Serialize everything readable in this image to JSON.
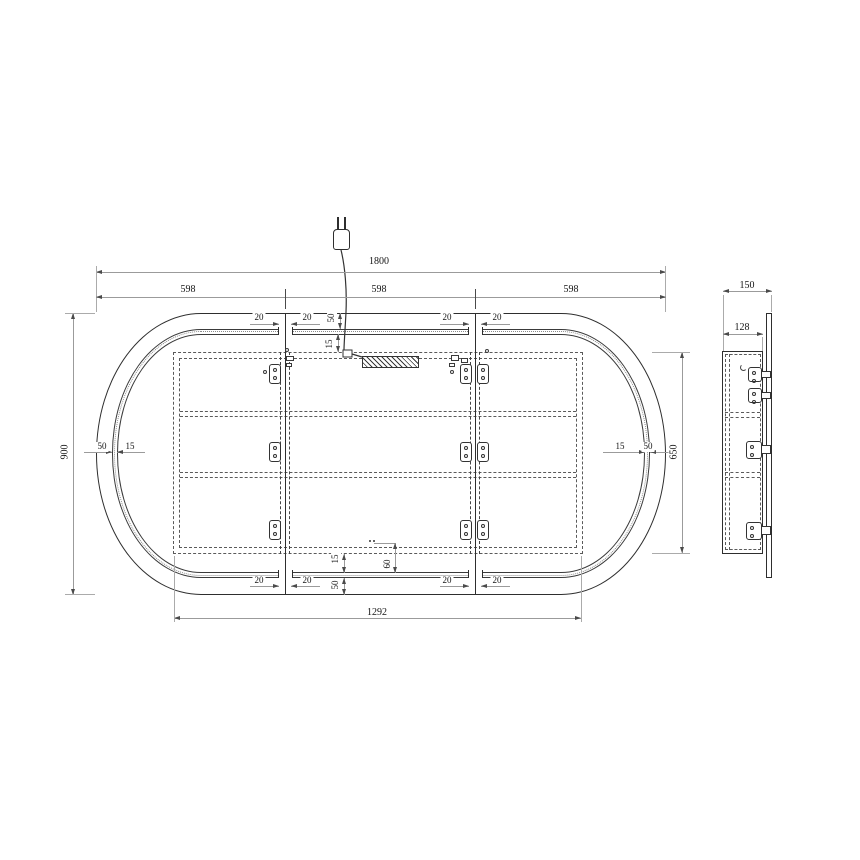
{
  "front_view": {
    "overall_width": "1800",
    "panel_width": "598",
    "overall_height": "900",
    "cabinet_width": "1292",
    "cabinet_height": "650",
    "frame_band": "50",
    "led_inset": "15",
    "door_gap": "20",
    "sensor_offset": "60"
  },
  "side_view": {
    "overall_depth": "150",
    "cabinet_depth": "128"
  }
}
